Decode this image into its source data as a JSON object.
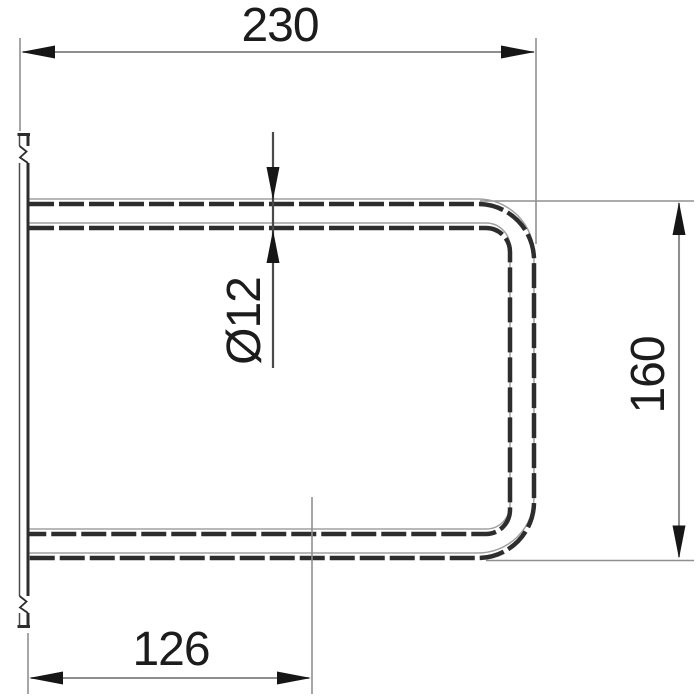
{
  "drawing": {
    "background": "#ffffff",
    "line_color": "#8f8f8f",
    "outline_color": "#2d2d2d",
    "text_color": "#1c1c1c",
    "labels": {
      "top_width": "230",
      "tube_diameter": "Ø12",
      "side_height": "160",
      "bottom_width": "126"
    }
  }
}
